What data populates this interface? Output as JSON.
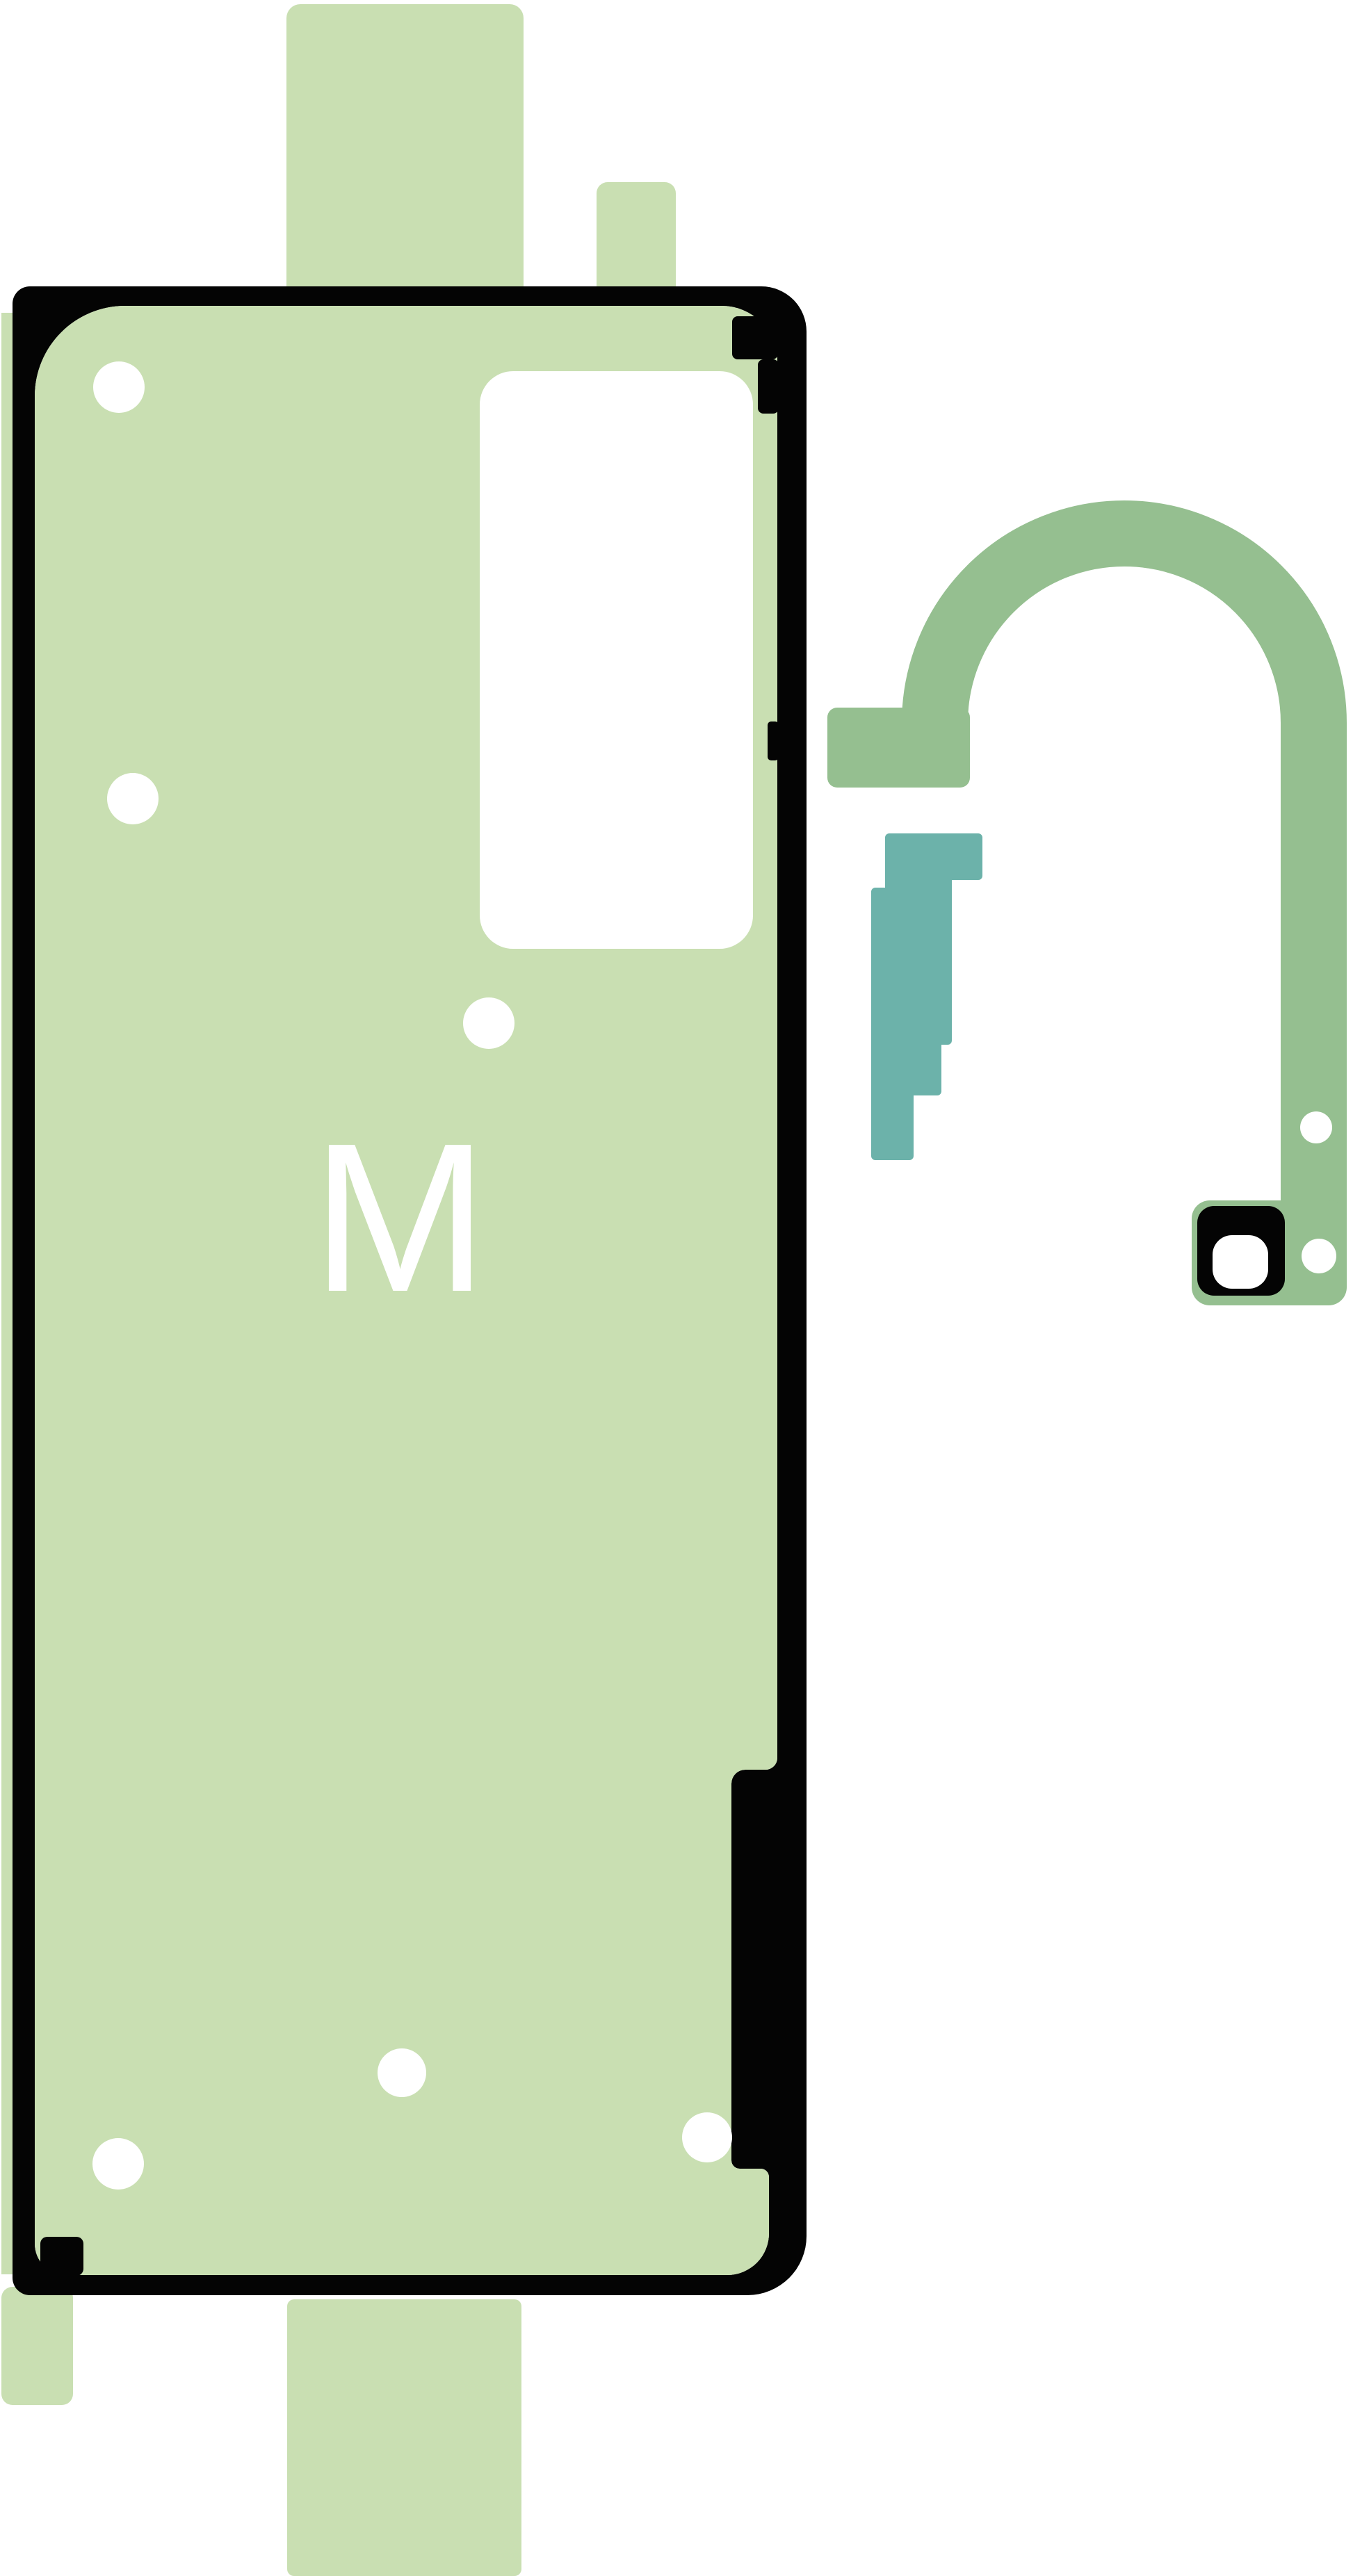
{
  "image": {
    "marking_letter": "M",
    "colors": {
      "liner_green": "#c9dfb2",
      "flex_green": "#95bf90",
      "spacer_teal": "#6cb2aa",
      "outline_black": "#040404",
      "cutout_white": "#ffffff"
    }
  }
}
